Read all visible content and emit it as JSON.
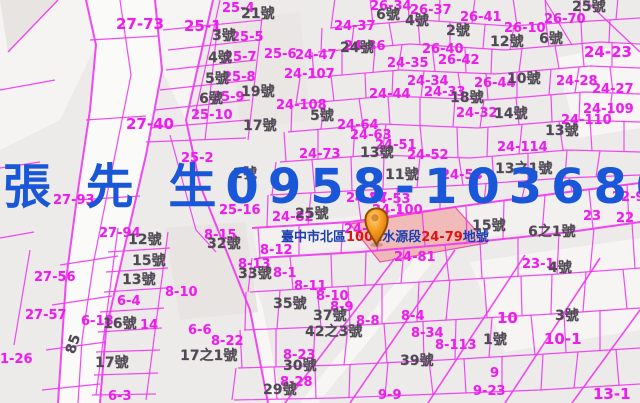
{
  "map": {
    "watermark": {
      "text": "張 先 生0958-103680",
      "color": "#1a57d8"
    },
    "location_label": {
      "segments": [
        {
          "text": "臺中市北區",
          "color": "#1c3fae"
        },
        {
          "text": "1001",
          "color": "#e01414"
        },
        {
          "text": "水源段",
          "color": "#1c3fae"
        },
        {
          "text": "24-79",
          "color": "#e01414"
        },
        {
          "text": "地號",
          "color": "#1c3fae"
        }
      ]
    },
    "marker": {
      "fill": "#f59a1e",
      "stroke": "#8f4a08"
    },
    "colors": {
      "background": "#ecebe9",
      "road_white": "#fafaf9",
      "parcel_line": "#f136f1",
      "parcel_text": "#ea1fea",
      "house_text": "#4f4953",
      "highlight_fill": "rgba(238,152,148,0.6)",
      "highlight_stroke": "#ee4fb0"
    },
    "parcel_labels": [
      {
        "t": "27-73",
        "x": 116,
        "y": 17,
        "s": 15
      },
      {
        "t": "25-1",
        "x": 184,
        "y": 19,
        "s": 15
      },
      {
        "t": "25-4",
        "x": 222,
        "y": 2
      },
      {
        "t": "26-34",
        "x": 370,
        "y": 0
      },
      {
        "t": "26-37",
        "x": 410,
        "y": 4
      },
      {
        "t": "26-41",
        "x": 460,
        "y": 11
      },
      {
        "t": "26-10",
        "x": 504,
        "y": 22
      },
      {
        "t": "26-70",
        "x": 544,
        "y": 13
      },
      {
        "t": "24-37",
        "x": 334,
        "y": 20
      },
      {
        "t": "24-36",
        "x": 344,
        "y": 40
      },
      {
        "t": "25-5",
        "x": 231,
        "y": 31
      },
      {
        "t": "25-6",
        "x": 264,
        "y": 48
      },
      {
        "t": "25-7",
        "x": 224,
        "y": 51
      },
      {
        "t": "24-47",
        "x": 295,
        "y": 49
      },
      {
        "t": "26-40",
        "x": 422,
        "y": 43
      },
      {
        "t": "26-42",
        "x": 438,
        "y": 54
      },
      {
        "t": "24-23",
        "x": 584,
        "y": 45,
        "s": 15
      },
      {
        "t": "24-35",
        "x": 387,
        "y": 57
      },
      {
        "t": "25-8",
        "x": 223,
        "y": 71
      },
      {
        "t": "24-107",
        "x": 284,
        "y": 68
      },
      {
        "t": "25-9",
        "x": 212,
        "y": 91
      },
      {
        "t": "25-10",
        "x": 191,
        "y": 109
      },
      {
        "t": "24-108",
        "x": 276,
        "y": 99
      },
      {
        "t": "24-44",
        "x": 369,
        "y": 88
      },
      {
        "t": "24-34",
        "x": 407,
        "y": 75
      },
      {
        "t": "24-33",
        "x": 424,
        "y": 86
      },
      {
        "t": "26-44",
        "x": 474,
        "y": 77
      },
      {
        "t": "24-28",
        "x": 556,
        "y": 75
      },
      {
        "t": "24-27",
        "x": 592,
        "y": 83
      },
      {
        "t": "24-32",
        "x": 456,
        "y": 107
      },
      {
        "t": "24-109",
        "x": 583,
        "y": 103
      },
      {
        "t": "24-110",
        "x": 561,
        "y": 114
      },
      {
        "t": "24-114",
        "x": 497,
        "y": 141
      },
      {
        "t": "24-64",
        "x": 337,
        "y": 119
      },
      {
        "t": "24-63",
        "x": 350,
        "y": 129
      },
      {
        "t": "24-51",
        "x": 375,
        "y": 139
      },
      {
        "t": "24-52",
        "x": 407,
        "y": 149
      },
      {
        "t": "24-73",
        "x": 299,
        "y": 148
      },
      {
        "t": "24-54",
        "x": 441,
        "y": 169
      },
      {
        "t": "25-2",
        "x": 181,
        "y": 152
      },
      {
        "t": "25-16",
        "x": 219,
        "y": 204
      },
      {
        "t": "27-93",
        "x": 53,
        "y": 194
      },
      {
        "t": "27-94",
        "x": 99,
        "y": 227
      },
      {
        "t": "24-57",
        "x": 346,
        "y": 192
      },
      {
        "t": "24-53",
        "x": 369,
        "y": 193
      },
      {
        "t": "24-100",
        "x": 372,
        "y": 204
      },
      {
        "t": "24-82",
        "x": 272,
        "y": 211
      },
      {
        "t": "24-78",
        "x": 344,
        "y": 223
      },
      {
        "t": "24-81",
        "x": 394,
        "y": 251
      },
      {
        "t": "27-40",
        "x": 126,
        "y": 117,
        "s": 15
      },
      {
        "t": "27-56",
        "x": 34,
        "y": 271
      },
      {
        "t": "27-57",
        "x": 25,
        "y": 309
      },
      {
        "t": "1-26",
        "x": 0,
        "y": 353
      },
      {
        "t": "8-15",
        "x": 204,
        "y": 229
      },
      {
        "t": "8-12",
        "x": 260,
        "y": 244
      },
      {
        "t": "8-13",
        "x": 238,
        "y": 258
      },
      {
        "t": "8-1",
        "x": 273,
        "y": 267
      },
      {
        "t": "8-11",
        "x": 294,
        "y": 280
      },
      {
        "t": "8-10",
        "x": 165,
        "y": 286
      },
      {
        "t": "8-10",
        "x": 316,
        "y": 290
      },
      {
        "t": "6-4",
        "x": 117,
        "y": 295
      },
      {
        "t": "6-18",
        "x": 81,
        "y": 315
      },
      {
        "t": "14",
        "x": 140,
        "y": 319
      },
      {
        "t": "6-6",
        "x": 188,
        "y": 324
      },
      {
        "t": "8-22",
        "x": 211,
        "y": 335
      },
      {
        "t": "8-23",
        "x": 283,
        "y": 349
      },
      {
        "t": "8-28",
        "x": 280,
        "y": 376
      },
      {
        "t": "6-3",
        "x": 108,
        "y": 390
      },
      {
        "t": "8-9",
        "x": 330,
        "y": 301
      },
      {
        "t": "8-8",
        "x": 356,
        "y": 315
      },
      {
        "t": "8-4",
        "x": 401,
        "y": 310
      },
      {
        "t": "8-34",
        "x": 411,
        "y": 327
      },
      {
        "t": "8-113",
        "x": 435,
        "y": 339
      },
      {
        "t": "9-9",
        "x": 378,
        "y": 389
      },
      {
        "t": "9-23",
        "x": 473,
        "y": 385
      },
      {
        "t": "9",
        "x": 490,
        "y": 367
      },
      {
        "t": "13-1",
        "x": 593,
        "y": 387,
        "s": 15
      },
      {
        "t": "10",
        "x": 497,
        "y": 311,
        "s": 15
      },
      {
        "t": "10-1",
        "x": 544,
        "y": 332,
        "s": 15
      },
      {
        "t": "23-1",
        "x": 522,
        "y": 258
      },
      {
        "t": "22-9",
        "x": 612,
        "y": 191
      },
      {
        "t": "23",
        "x": 583,
        "y": 210
      },
      {
        "t": "22",
        "x": 616,
        "y": 212
      }
    ],
    "house_labels": [
      {
        "t": "21號",
        "x": 241,
        "y": 7
      },
      {
        "t": "3號",
        "x": 212,
        "y": 29
      },
      {
        "t": "4號",
        "x": 208,
        "y": 51
      },
      {
        "t": "5號",
        "x": 205,
        "y": 72
      },
      {
        "t": "6號",
        "x": 199,
        "y": 92
      },
      {
        "t": "19號",
        "x": 241,
        "y": 85
      },
      {
        "t": "17號",
        "x": 243,
        "y": 119
      },
      {
        "t": "6號",
        "x": 376,
        "y": 8
      },
      {
        "t": "4號",
        "x": 405,
        "y": 14
      },
      {
        "t": "2號",
        "x": 446,
        "y": 24
      },
      {
        "t": "25號",
        "x": 572,
        "y": 0
      },
      {
        "t": "12號",
        "x": 490,
        "y": 35
      },
      {
        "t": "6號",
        "x": 539,
        "y": 32
      },
      {
        "t": "24號",
        "x": 340,
        "y": 41
      },
      {
        "t": "10號",
        "x": 507,
        "y": 72
      },
      {
        "t": "18號",
        "x": 450,
        "y": 91
      },
      {
        "t": "14號",
        "x": 494,
        "y": 107
      },
      {
        "t": "13號",
        "x": 545,
        "y": 124
      },
      {
        "t": "5號",
        "x": 310,
        "y": 109
      },
      {
        "t": "13號",
        "x": 360,
        "y": 146
      },
      {
        "t": "11號",
        "x": 385,
        "y": 168
      },
      {
        "t": "2號",
        "x": 233,
        "y": 167
      },
      {
        "t": "13之1號",
        "x": 495,
        "y": 162
      },
      {
        "t": "15號",
        "x": 472,
        "y": 219
      },
      {
        "t": "6之1號",
        "x": 528,
        "y": 225
      },
      {
        "t": "25號",
        "x": 295,
        "y": 207
      },
      {
        "t": "12號",
        "x": 128,
        "y": 233
      },
      {
        "t": "15號",
        "x": 132,
        "y": 254
      },
      {
        "t": "13號",
        "x": 122,
        "y": 273
      },
      {
        "t": "16號",
        "x": 103,
        "y": 317
      },
      {
        "t": "17號",
        "x": 95,
        "y": 356
      },
      {
        "t": "32號",
        "x": 207,
        "y": 237
      },
      {
        "t": "33號",
        "x": 238,
        "y": 267
      },
      {
        "t": "35號",
        "x": 273,
        "y": 297
      },
      {
        "t": "17之1號",
        "x": 180,
        "y": 349
      },
      {
        "t": "37號",
        "x": 313,
        "y": 309
      },
      {
        "t": "42之3號",
        "x": 305,
        "y": 325
      },
      {
        "t": "30號",
        "x": 283,
        "y": 359
      },
      {
        "t": "29號",
        "x": 263,
        "y": 383
      },
      {
        "t": "39號",
        "x": 400,
        "y": 354
      },
      {
        "t": "3號",
        "x": 555,
        "y": 309
      },
      {
        "t": "1號",
        "x": 483,
        "y": 333
      },
      {
        "t": "4號",
        "x": 548,
        "y": 261
      },
      {
        "t": "85",
        "x": 64,
        "y": 337,
        "r": -72
      }
    ]
  }
}
